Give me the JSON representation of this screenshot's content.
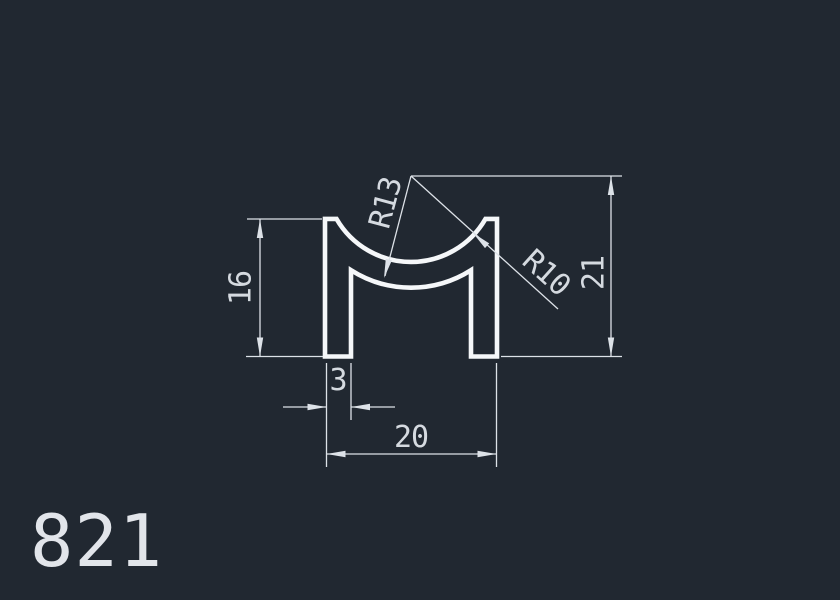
{
  "colors": {
    "background": "#212831",
    "profile": "#f5f7f9",
    "dim": "#dde2e8",
    "dimtext": "#d5dae0",
    "partnum": "#e2e5ea"
  },
  "drawing": {
    "part_number": "821",
    "dimensions": {
      "leg_height": "16",
      "leg_width": "3",
      "overall_width": "20",
      "center_height": "21",
      "inner_radius": "R13",
      "outer_radius": "R10"
    }
  }
}
